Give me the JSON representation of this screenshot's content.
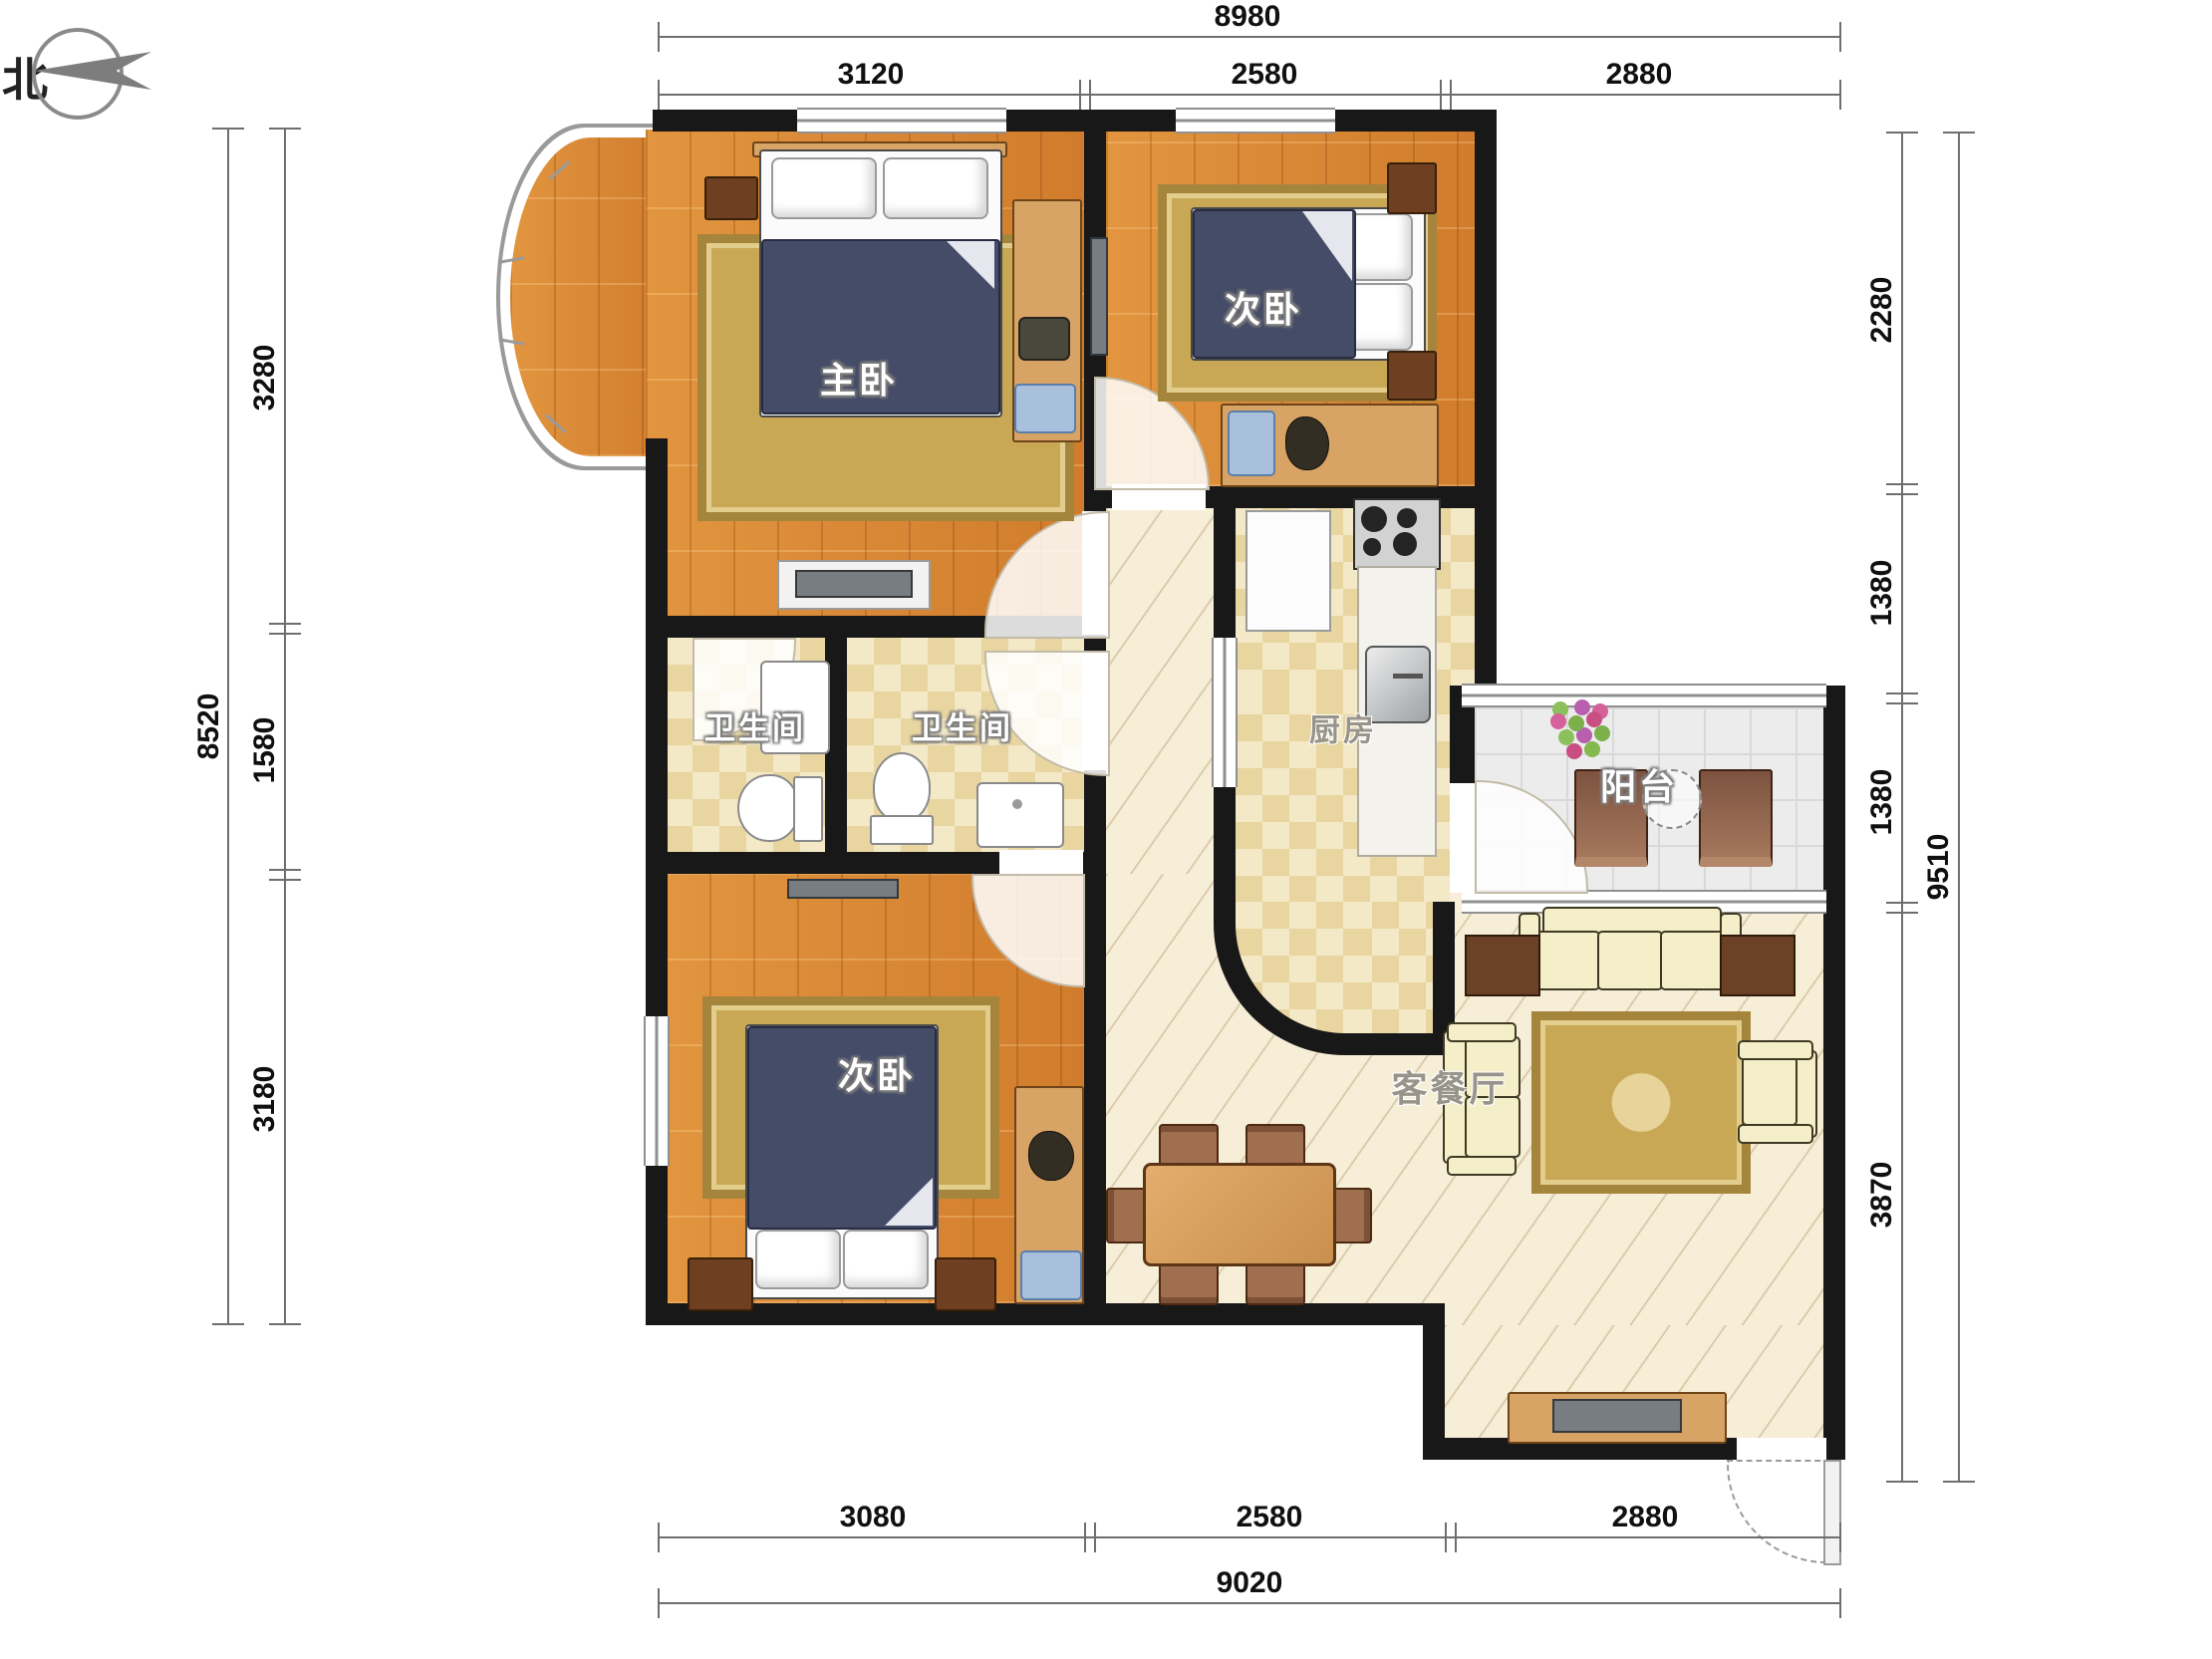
{
  "compass": {
    "north_label": "北"
  },
  "rooms": {
    "master_bedroom": {
      "label": "主卧"
    },
    "second_bedroom_top": {
      "label": "次卧"
    },
    "second_bedroom_bottom": {
      "label": "次卧"
    },
    "bathroom_left": {
      "label": "卫生间"
    },
    "bathroom_right": {
      "label": "卫生间"
    },
    "kitchen": {
      "label": "厨房"
    },
    "balcony": {
      "label": "阳台"
    },
    "living_dining": {
      "label": "客餐厅"
    }
  },
  "dimensions_mm": {
    "top": {
      "total": "8980",
      "segments": [
        "3120",
        "2580",
        "2880"
      ]
    },
    "bottom": {
      "total": "9020",
      "segments": [
        "3080",
        "2580",
        "2880"
      ]
    },
    "left": {
      "total": "8520",
      "segments": [
        "3280",
        "1580",
        "3180"
      ]
    },
    "right": {
      "total": "9510",
      "segments": [
        "2280",
        "1380",
        "1380",
        "3870"
      ]
    }
  },
  "colors": {
    "wall": "#181818",
    "wood_floor": "#dd8a3f",
    "tile_floor": "#eede9f",
    "hall_floor": "#f6eed7",
    "balcony_floor": "#ececec",
    "rug": "#c9a855",
    "bed_duvet": "#454c68"
  }
}
